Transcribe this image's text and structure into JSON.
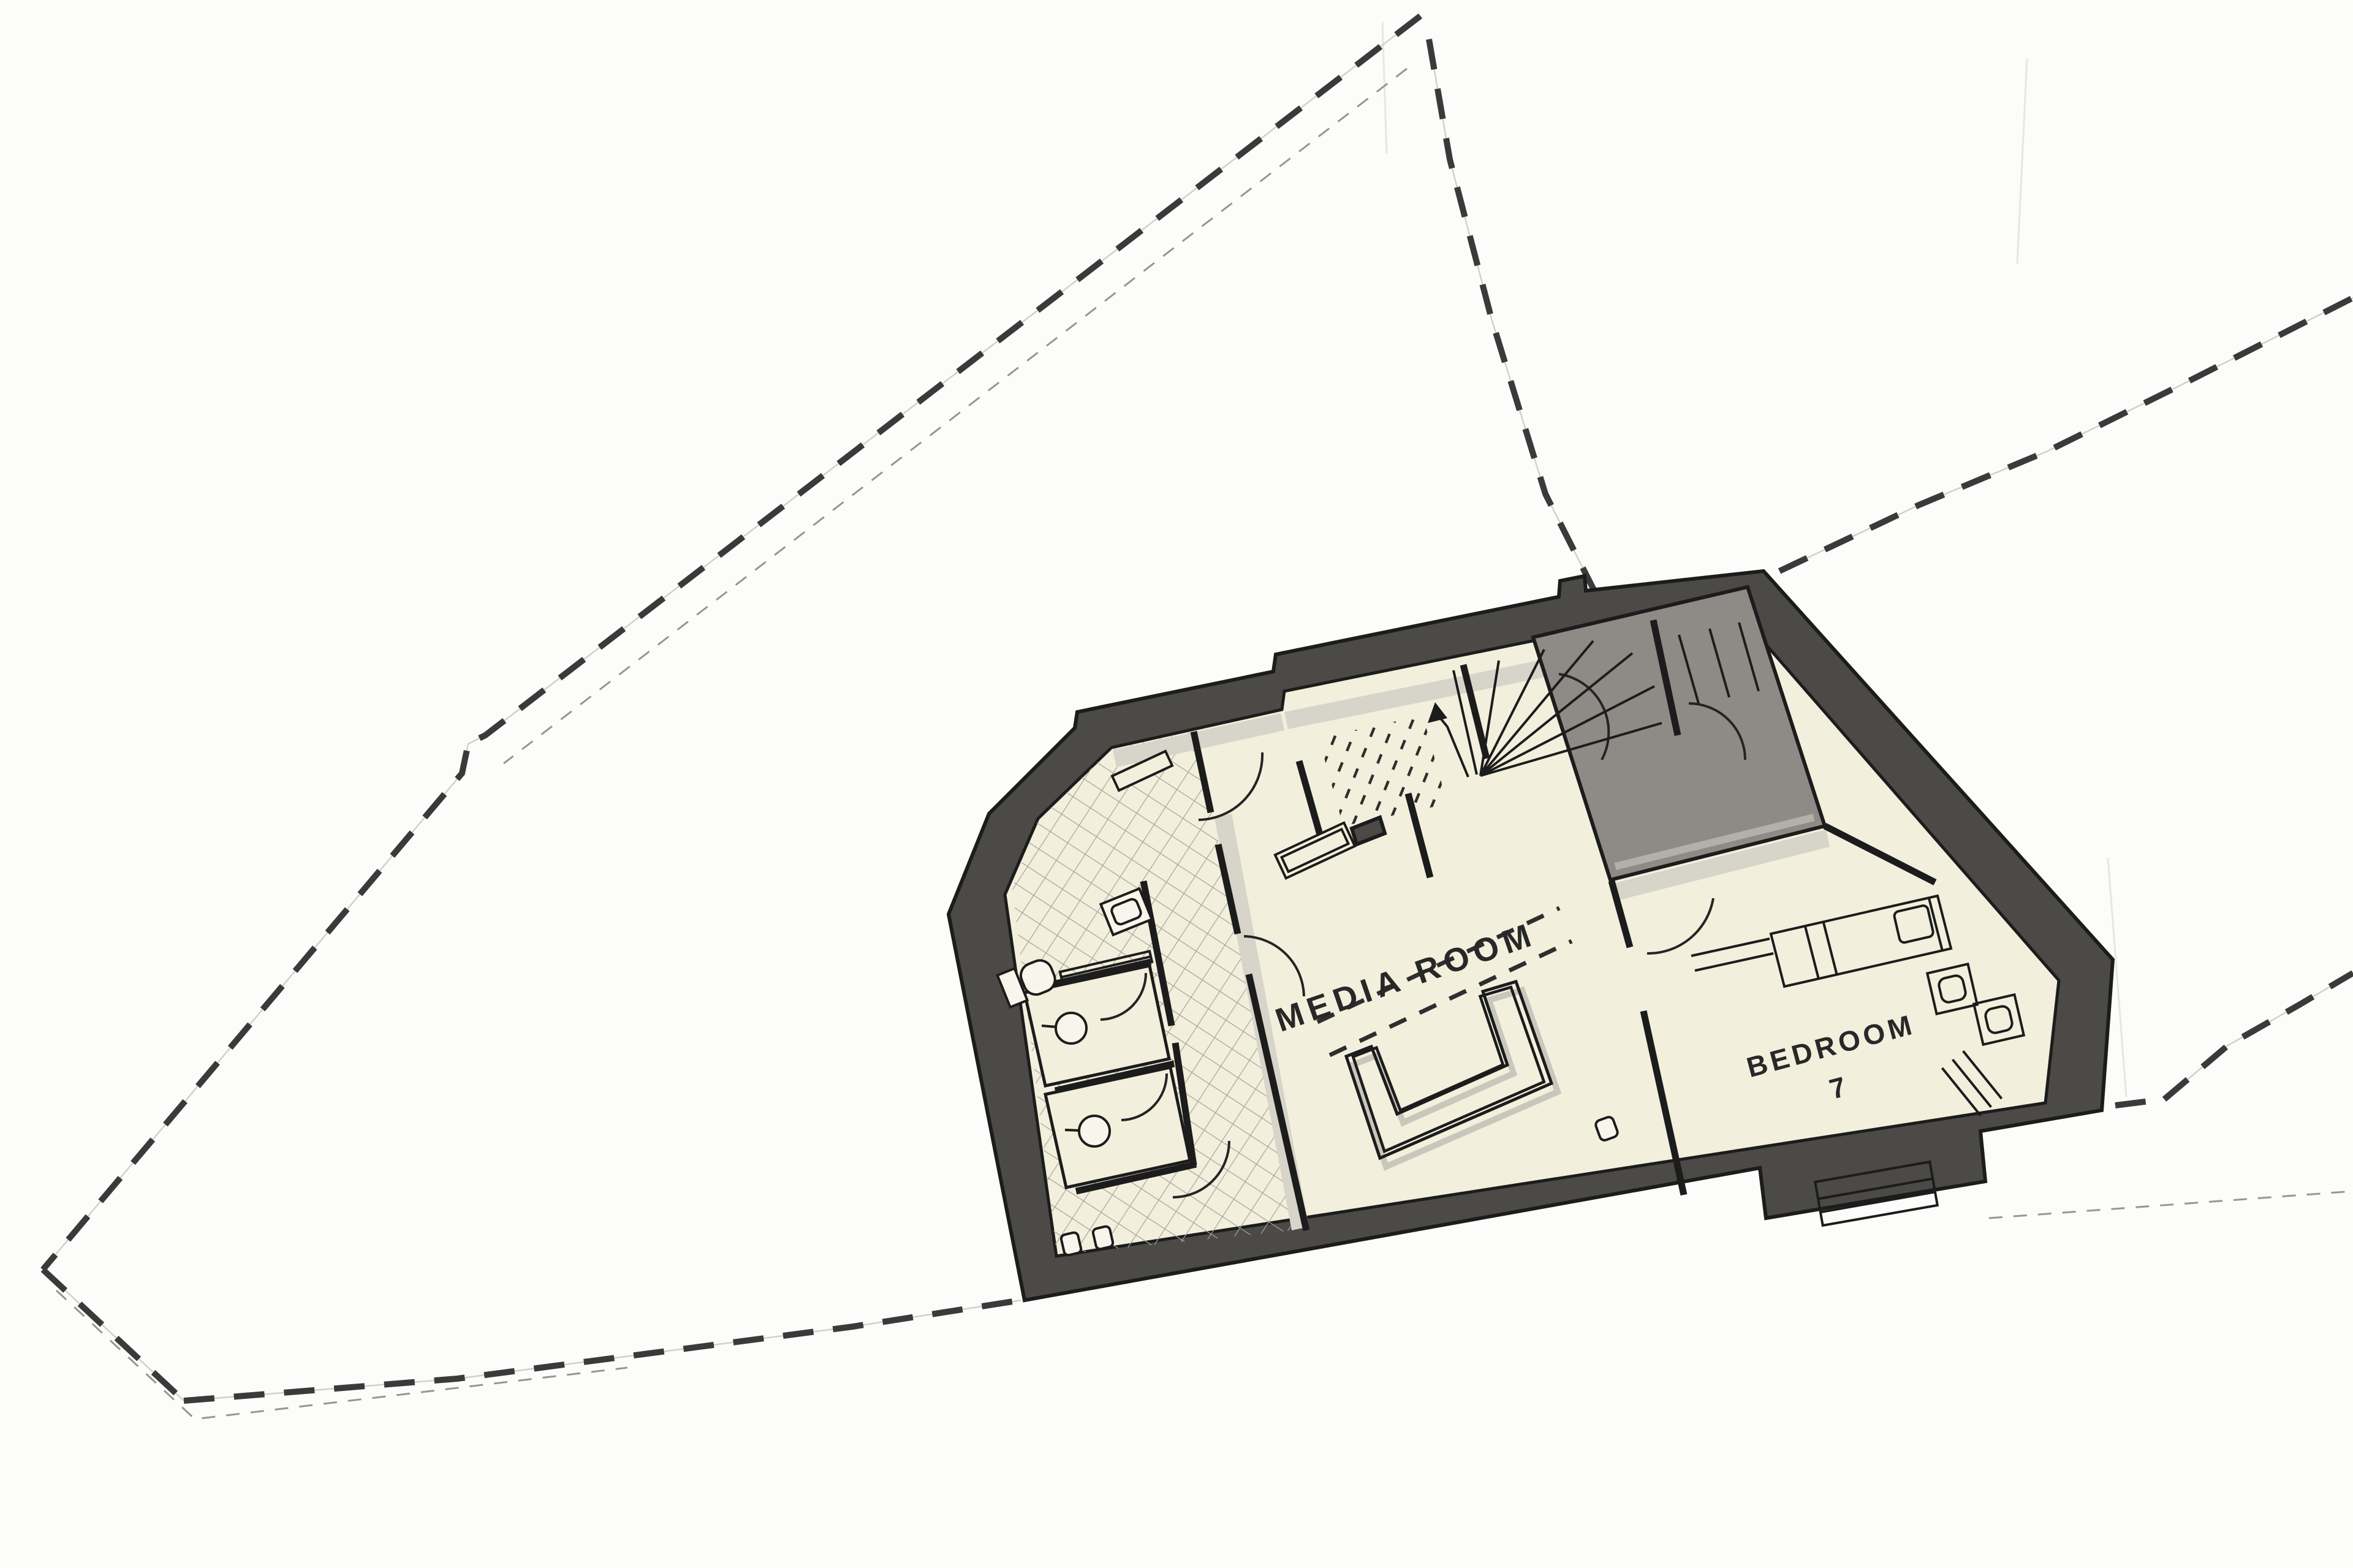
{
  "palette": {
    "paper": "#fcfcfa",
    "boundary": "#3a3a3a",
    "faint": "#98968f",
    "hairline": "#d2d0cb",
    "wallDark": "#4b4a47",
    "ink": "#1c1c1c",
    "cream": "#f2efdd",
    "grayRoom": "#8e8b86",
    "grayEdge": "#b3b0aa",
    "tileLine": "#a7a49a",
    "shadow": "#d7d4c9",
    "text": "#282828"
  },
  "labels": {
    "media_room": "MEDIA ROOM",
    "bedroom": "BEDROOM",
    "bedroom_number": "7"
  },
  "boundary": {
    "bold_left": "2318,26 792,1200 764,1214 754,1262 70,2072",
    "bold_bl": "70,2072 300,2286",
    "bold_bottom": "300,2286 746,2250 1392,2165 1666,2122",
    "bold_br": "3452,1804 3532,1794",
    "bold_right_up": "3532,1794 3636,1706 3752,1640 3840,1588",
    "bold_apex_steep": "2332,64 2366,260 2434,520 2522,806 2622,1004",
    "bold_ne": "2904,932 3132,824 3342,736 3560,628 3840,486",
    "faint_left": "2296,112 822,1246",
    "faint_bl": "92,2106 318,2316 1024,2232",
    "faint_br": "3246,1988 3840,1944"
  },
  "building": {
    "outline": "1548,1492 1614,1328 1754,1188 1758,1162 2078,1096 2082,1068 2544,974 2546,948 2586,940 2588,964 2878,932 3448,1566 3430,1812 3232,1846 3240,1928 2882,1988 2872,1906 1672,2122",
    "interior": "1640,1460 1694,1336 1814,1220 2092,1158 2096,1128 2560,1034 2840,1004 3360,1600 3338,1800 1724,2050",
    "gray_room": "2502,1040 2852,958 2978,1348 2628,1436",
    "gray_edge_bottom": "2636,1414 2960,1334",
    "tile_region": "1652,1448 1694,1338 1814,1222 1948,1194 2130,2006 1724,2048",
    "stall_1": "1672,1620 1876,1576 1908,1728 1706,1772",
    "stall_2": "1706,1786 1910,1742 1942,1894 1740,1938",
    "dots_region": "2152,1204 2322,1168 2362,1312 2192,1348",
    "shadow_media_top": "2096,1162 2560,1068 2566,1096 2102,1190",
    "shadow_bath_top": "1816,1224 2090,1164 2096,1192 1822,1252",
    "shadow_bed_top": "2632,1442 2980,1354 2986,1382 2638,1470",
    "shadow_partition": "1982,1334 2010,1328 2136,2002 2108,2008",
    "step_stub": "2206,1352 2252,1334 2260,1360 2214,1378"
  },
  "walls": {
    "partition_a": "1948,1194 1976,1326",
    "partition_b": "1988,1378 2020,1524",
    "partition_c": "2038,1590 2132,2008",
    "bath_right_a": "1866,1438 1912,1674",
    "bath_right_b": "1918,1702 1948,1902",
    "stall_top": "1684,1614 1878,1570",
    "stall_mid": "1722,1780 1916,1736",
    "stall_bottom": "1756,1944 1952,1900",
    "stair_left": "2120,1242 2154,1362",
    "media_hall": "2298,1295 2334,1432",
    "hall_stair": "2388,1085 2426,1238",
    "stair_right": "2698,1012 2738,1200",
    "bed_left_a": "2630,1438 2660,1546",
    "bed_left_b": "2682,1650 2748,1950",
    "bed_top_right": "2978,1348 3158,1440"
  },
  "doors": {
    "d1": "M 2060,1228 A 106 106 0 0 1 1956,1338",
    "d2": "M 2030,1528 A 100 100 0 0 1 2128,1626",
    "d3": "M 1870,1588 A 76 76 0 0 1 1796,1664",
    "d4": "M 1904,1752 A 76 76 0 0 1 1830,1828",
    "d5": "M 2006,1862 A 92 92 0 0 1 1914,1954",
    "d6": "M 2544,1100 A 96 96 0 0 1 2614,1240",
    "d7": "M 2688,1556 A 108 108 0 0 0 2796,1466",
    "d8": "M 2756,1148 A 92 92 0 0 1 2848,1240"
  },
  "stair": {
    "tread_1": "2416,1266 2446,1078",
    "tread_2": "2416,1266 2520,1060",
    "tread_3": "2416,1266 2600,1046",
    "tread_4": "2416,1266 2664,1066",
    "tread_5": "2416,1266 2700,1120",
    "tread_6": "2416,1266 2712,1180",
    "edge": "2372,1094 2410,1264",
    "tread_r1": "2740,1036 2772,1148",
    "tread_r2": "2790,1026 2822,1138",
    "tread_r3": "2838,1016 2870,1128",
    "arrow_line": "2396,1268 2362,1186 2344,1164",
    "arrow_head": "2330,1180 2342,1146 2362,1172"
  },
  "media": {
    "projection_1": "2150,1668 2545,1482",
    "projection_2": "2170,1722 2565,1536",
    "sofa_outline": "M 2197,1724 L 2252,1890 L 2532,1768 L 2474,1602 L 2420,1618 L 2460,1738 L 2280,1818 L 2238,1708 Z"
  },
  "bedroom": {
    "bed": "2890,1524 3162,1462 3184,1548 2912,1610",
    "headboard": "3148,1466 3170,1552",
    "fold_1": "2946,1512 2968,1598",
    "fold_2": "2976,1506 2998,1592",
    "bench_1": "2760,1560 2888,1532",
    "bench_2": "2766,1584 2894,1556"
  }
}
